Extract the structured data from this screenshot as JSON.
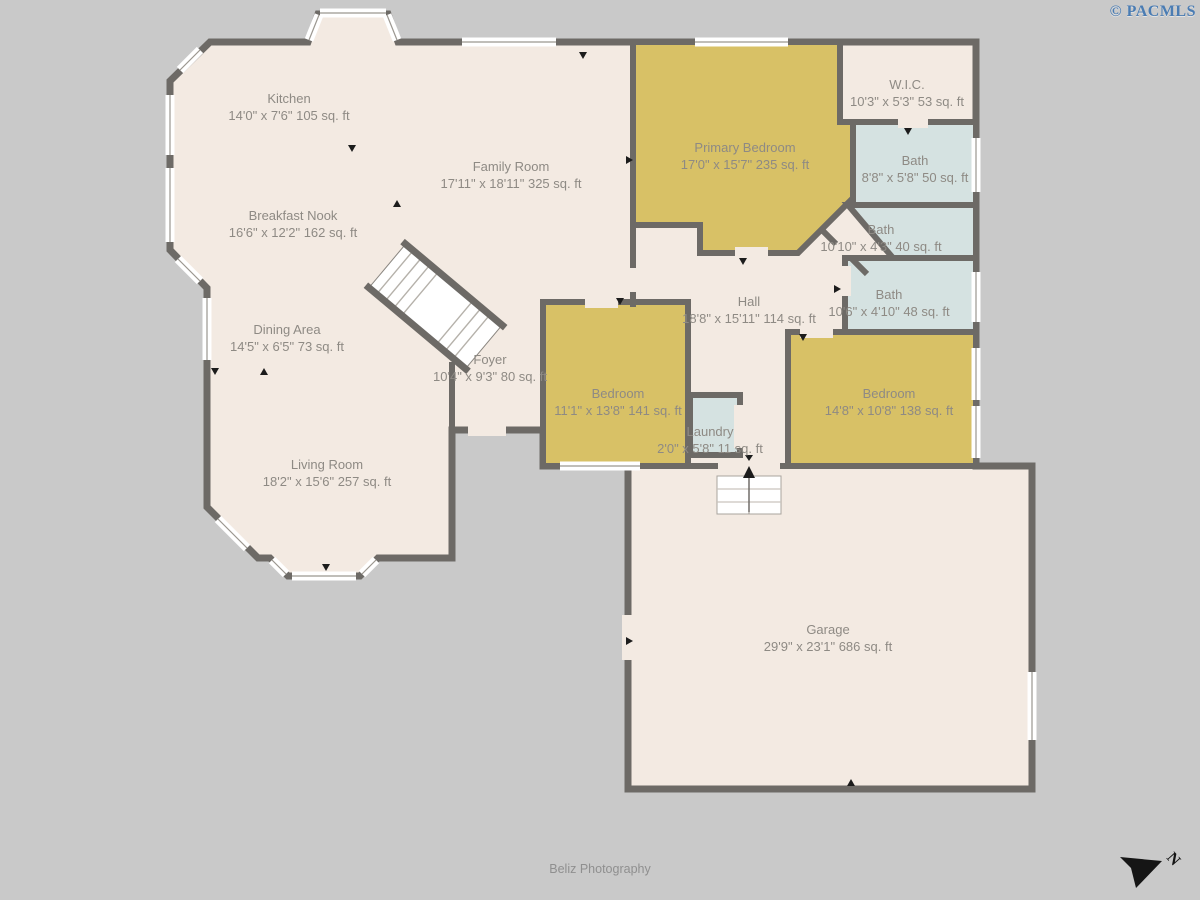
{
  "branding": {
    "watermark": "© PACMLS",
    "credit": "Beliz Photography",
    "compass_letter": "N"
  },
  "colors": {
    "background": "#c9c9c9",
    "floor": "#f3eae2",
    "bedroom": "#d8c166",
    "bath": "#d5e2e1",
    "wall": "#6d6a66",
    "label": "#8e8a84",
    "watermark": "#4a7cb3"
  },
  "rooms": [
    {
      "id": "kitchen",
      "name": "Kitchen",
      "dims": "14'0\" x 7'6\" 105 sq. ft"
    },
    {
      "id": "family-room",
      "name": "Family Room",
      "dims": "17'11\" x 18'11\" 325 sq. ft"
    },
    {
      "id": "breakfast-nook",
      "name": "Breakfast Nook",
      "dims": "16'6\" x 12'2\" 162 sq. ft"
    },
    {
      "id": "dining-area",
      "name": "Dining Area",
      "dims": "14'5\" x 6'5\" 73 sq. ft"
    },
    {
      "id": "living-room",
      "name": "Living Room",
      "dims": "18'2\" x 15'6\" 257 sq. ft"
    },
    {
      "id": "foyer",
      "name": "Foyer",
      "dims": "10'4\" x 9'3\" 80 sq. ft"
    },
    {
      "id": "primary-bedroom",
      "name": "Primary Bedroom",
      "dims": "17'0\" x 15'7\" 235 sq. ft"
    },
    {
      "id": "wic",
      "name": "W.I.C.",
      "dims": "10'3\" x 5'3\" 53 sq. ft"
    },
    {
      "id": "bath-1",
      "name": "Bath",
      "dims": "8'8\" x 5'8\" 50 sq. ft"
    },
    {
      "id": "bath-2",
      "name": "Bath",
      "dims": "10'10\" x 4'3\" 40 sq. ft"
    },
    {
      "id": "bath-3",
      "name": "Bath",
      "dims": "10'6\" x 4'10\" 48 sq. ft"
    },
    {
      "id": "hall",
      "name": "Hall",
      "dims": "18'8\" x 15'11\" 114 sq. ft"
    },
    {
      "id": "bedroom-1",
      "name": "Bedroom",
      "dims": "11'1\" x 13'8\" 141 sq. ft"
    },
    {
      "id": "laundry",
      "name": "Laundry",
      "dims": "2'0\" x 5'8\" 11 sq. ft"
    },
    {
      "id": "bedroom-2",
      "name": "Bedroom",
      "dims": "14'8\" x 10'8\" 138 sq. ft"
    },
    {
      "id": "garage",
      "name": "Garage",
      "dims": "29'9\" x 23'1\" 686 sq. ft"
    }
  ]
}
